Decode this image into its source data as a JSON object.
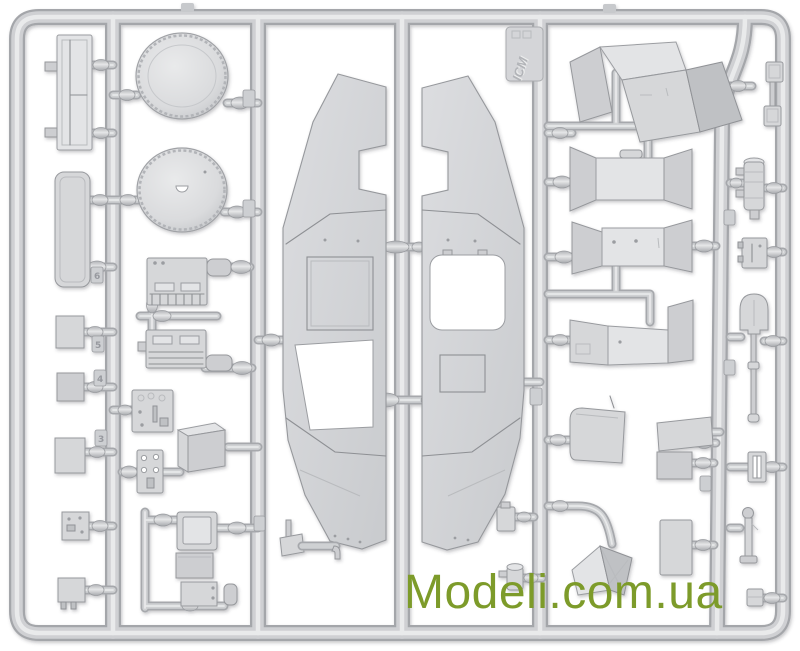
{
  "watermark": {
    "text": "Modeli.com.ua"
  },
  "sprue": {
    "brand": "ICM",
    "description": "injection-molded model kit sprue with vehicle hull halves and detail parts",
    "tags": [
      "6",
      "5",
      "4",
      "3"
    ]
  },
  "colors": {
    "background": "#ffffff",
    "watermark": "#7d9b2a",
    "plastic": "#d6d7d9",
    "plastic_dark": "#a4a6aa",
    "plastic_light": "#e9eaeb"
  }
}
